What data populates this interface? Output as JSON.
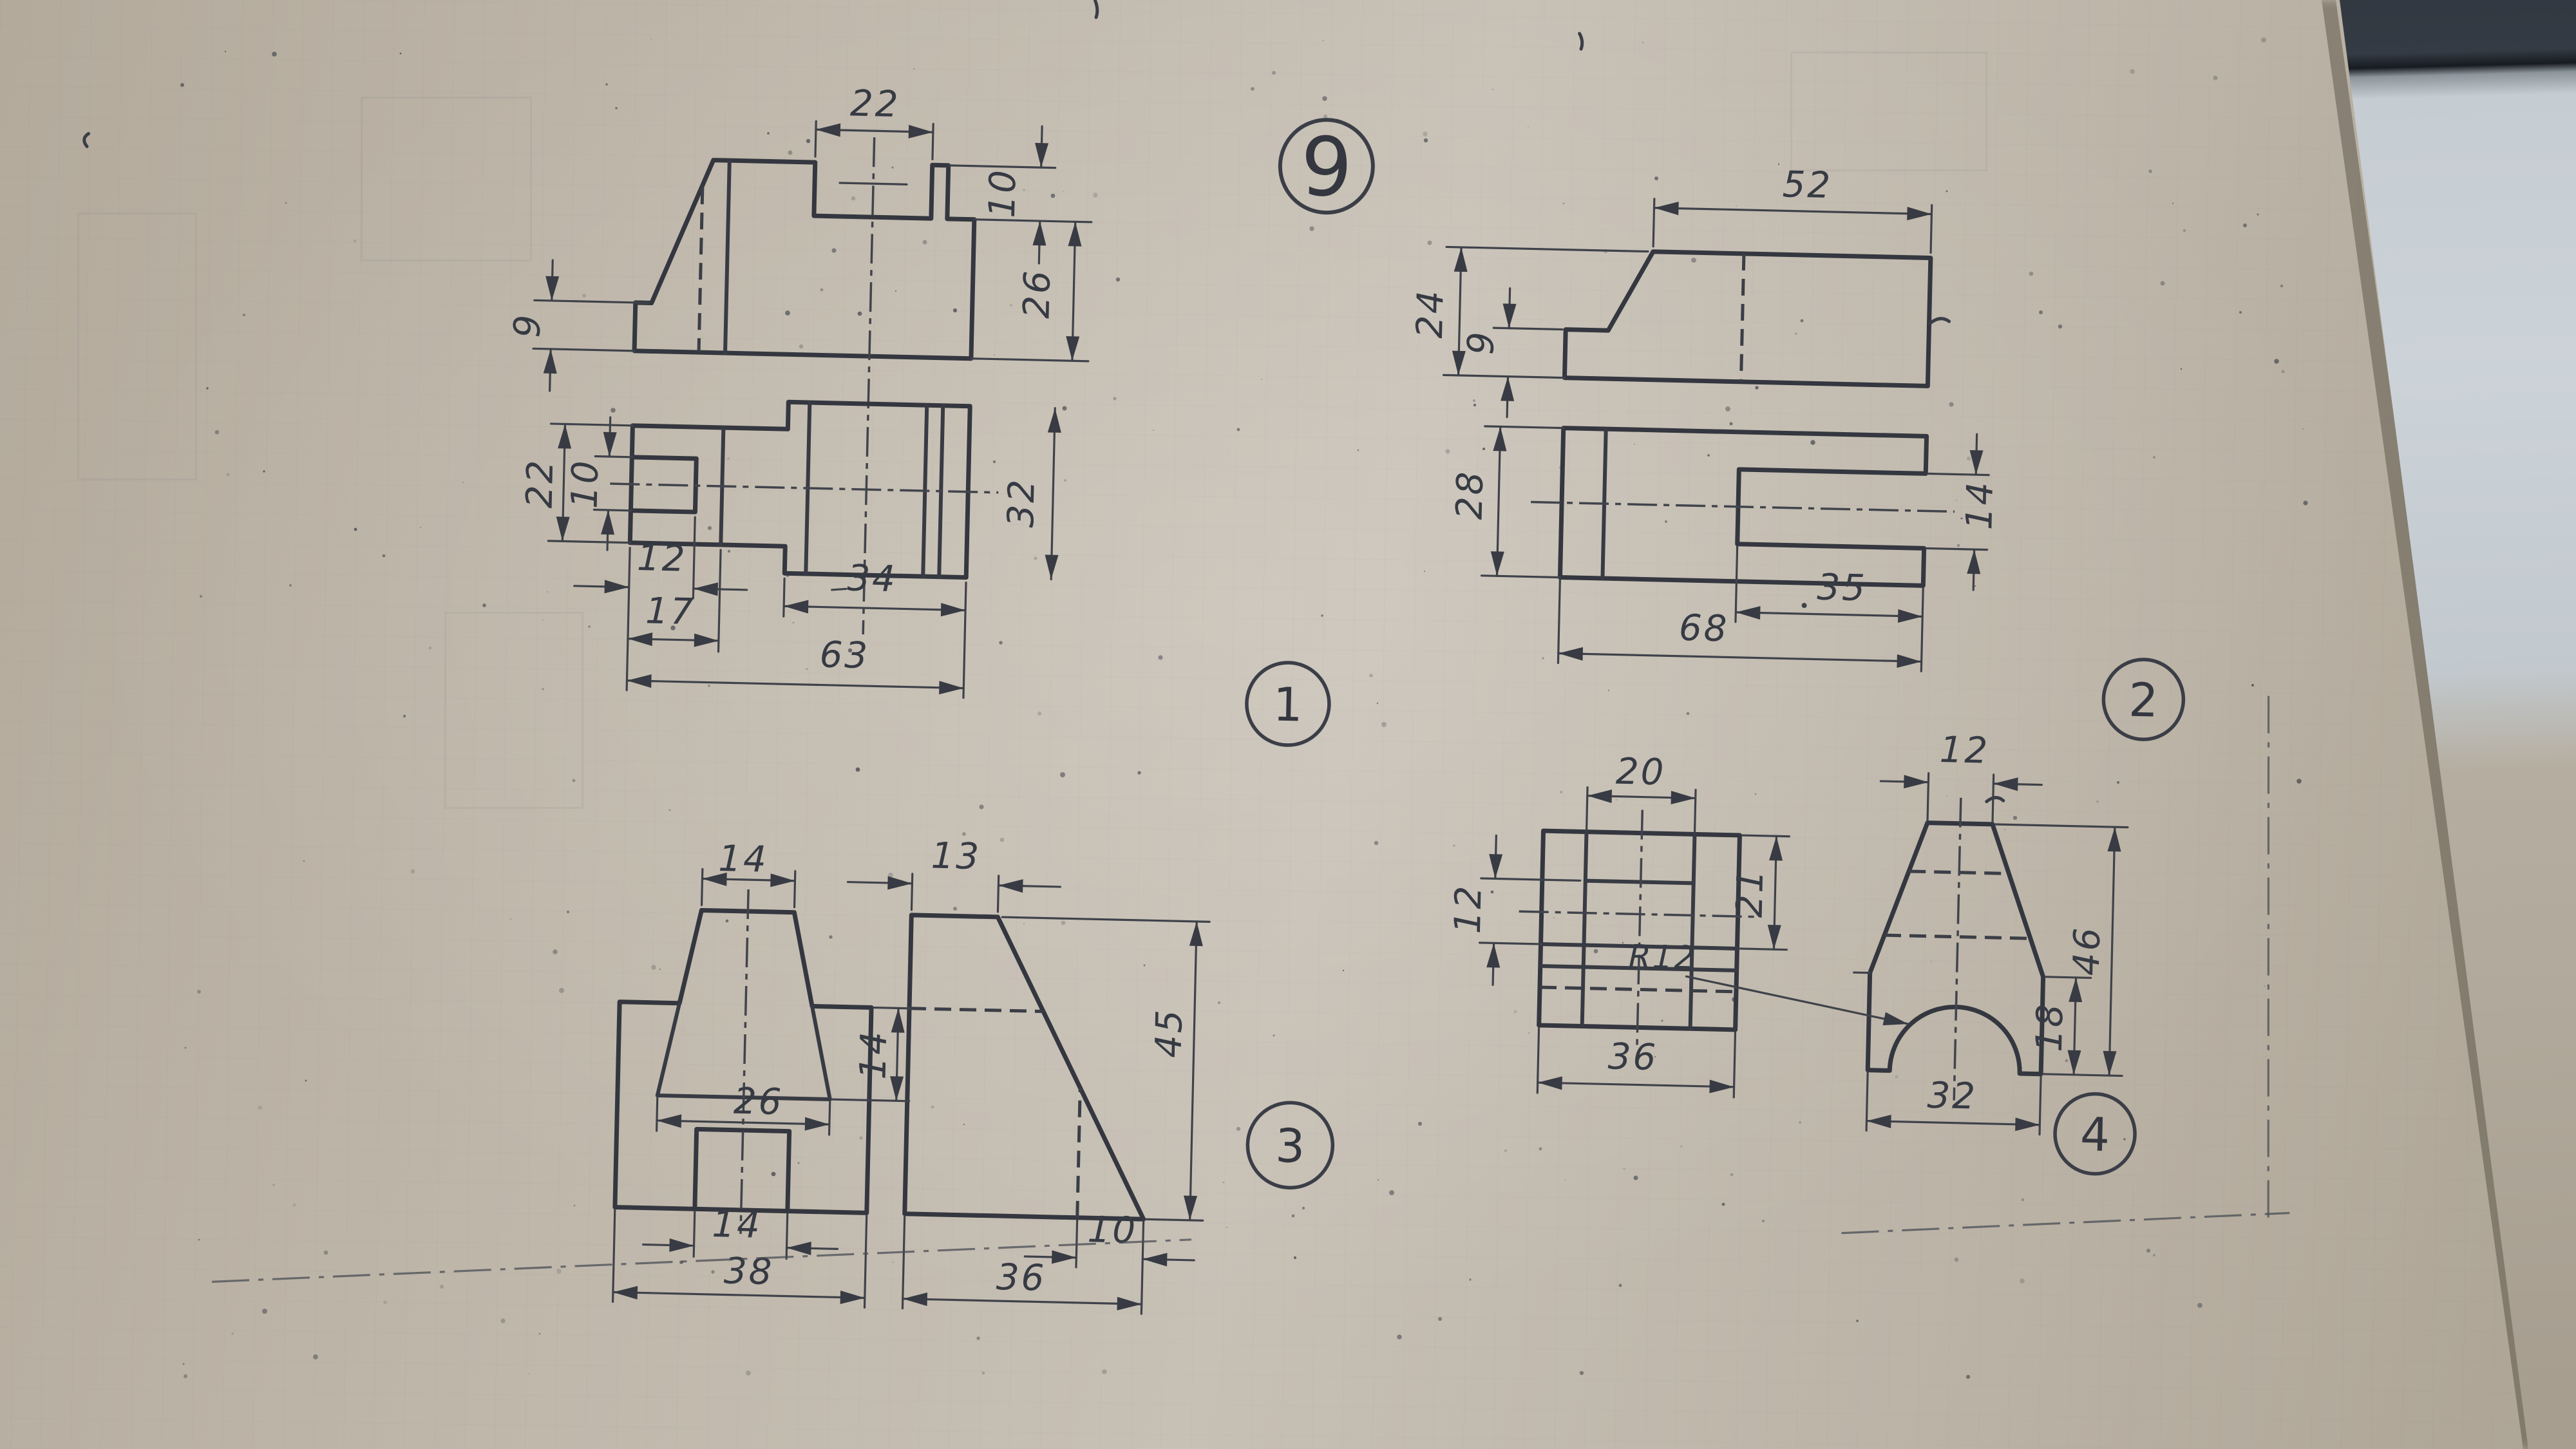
{
  "sheet": {
    "number": "9"
  },
  "problems": {
    "p1": {
      "badge": "1",
      "dims": {
        "notch_width": "22",
        "step_depth": "10",
        "right_height": "26",
        "left_height": "9",
        "plan_height": "22",
        "slot_width": "10",
        "slot_length": "12",
        "left_length": "17",
        "right_length": "34",
        "total_length": "63",
        "plan_width": "32"
      }
    },
    "p2": {
      "badge": "2",
      "dims": {
        "top_width": "52",
        "height": "24",
        "left_height": "9",
        "plan_depth": "28",
        "slot_height": "14",
        "slot_depth": "35",
        "total_length": "68"
      }
    },
    "p3": {
      "badge": "3",
      "dims": {
        "boss_top_width": "14",
        "side_top_width": "13",
        "boss_height": "14",
        "boss_base_width": "26",
        "height": "45",
        "slot_width": "14",
        "front_width": "38",
        "side_bottom_width": "36",
        "side_bottom_offset": "10"
      }
    },
    "p4": {
      "badge": "4",
      "dims": {
        "boss_width": "20",
        "top_width": "12",
        "pocket_height": "12",
        "plan_depth": "21",
        "arch_radius": "R12",
        "plan_width": "36",
        "bottom_width": "32",
        "height": "46",
        "base_height": "18"
      }
    }
  }
}
